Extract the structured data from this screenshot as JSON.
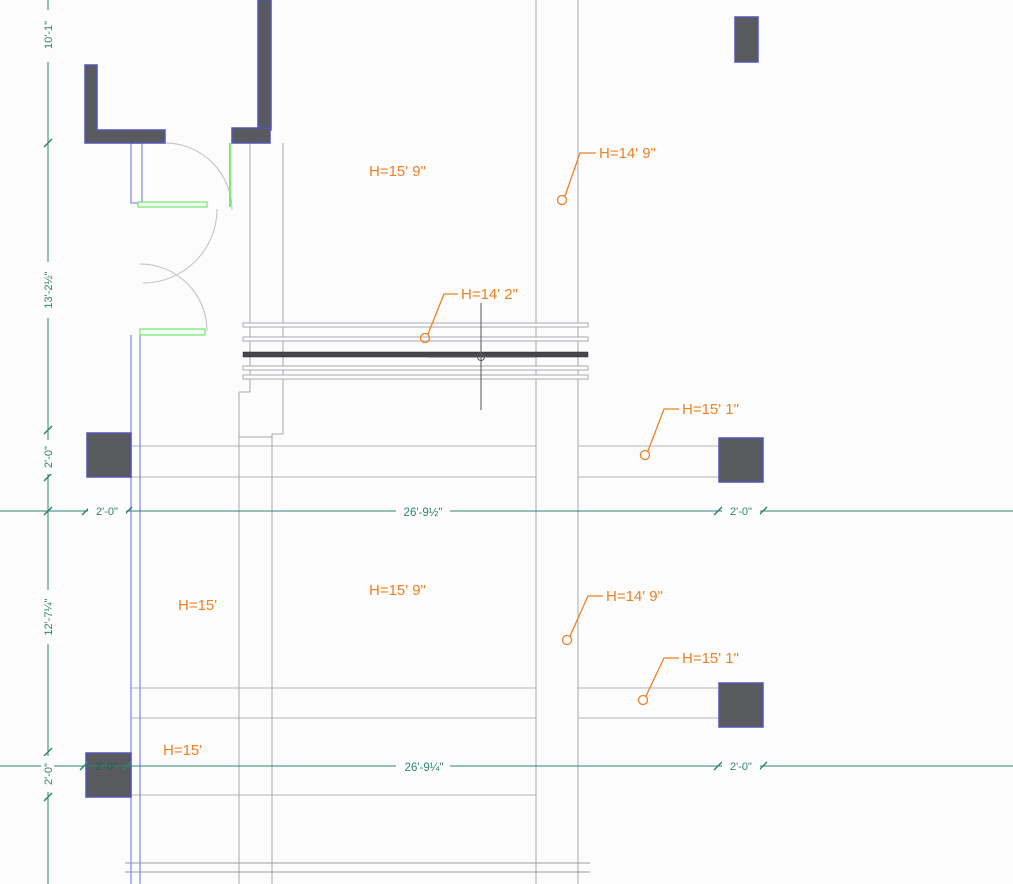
{
  "app": {
    "view": "cad-plan-viewport",
    "cursor": {
      "type": "crosshair-with-pickbox",
      "x": 481,
      "y": 357
    }
  },
  "colors": {
    "dimension_teal": "#2e8471",
    "annotation_orange": "#ee8124",
    "column_fill": "#595a5e",
    "column_border": "#5454b6",
    "wall_blue": "#8c8ce6",
    "door_green": "#7ce87c",
    "line_gray": "#a6a6ae",
    "selected_dark": "#46464a"
  },
  "dimensions": {
    "left": [
      {
        "label": "10'-1\""
      },
      {
        "label": "13'-2½\""
      },
      {
        "label": "2'-0\""
      },
      {
        "label": "12'-7¼\""
      },
      {
        "label": "2'-0\""
      }
    ],
    "row_upper": [
      {
        "label": "2'-0\""
      },
      {
        "label": "26'-9½\""
      },
      {
        "label": "2'-0\""
      }
    ],
    "row_lower": [
      {
        "label": "2'-0\""
      },
      {
        "label": "26'-9¼\""
      },
      {
        "label": "2'-0\""
      }
    ]
  },
  "heights": [
    {
      "id": "upper-center",
      "label": "H=15' 9\""
    },
    {
      "id": "upper-right",
      "label": "H=14' 9\""
    },
    {
      "id": "window-head",
      "label": "H=14' 2\""
    },
    {
      "id": "mid-right",
      "label": "H=15' 1\""
    },
    {
      "id": "lower-center",
      "label": "H=15' 9\""
    },
    {
      "id": "mid-left",
      "label": "H=15'"
    },
    {
      "id": "lower-right",
      "label": "H=14' 9\""
    },
    {
      "id": "bottom-right",
      "label": "H=15' 1\""
    },
    {
      "id": "bottom-left",
      "label": "H=15'"
    }
  ]
}
